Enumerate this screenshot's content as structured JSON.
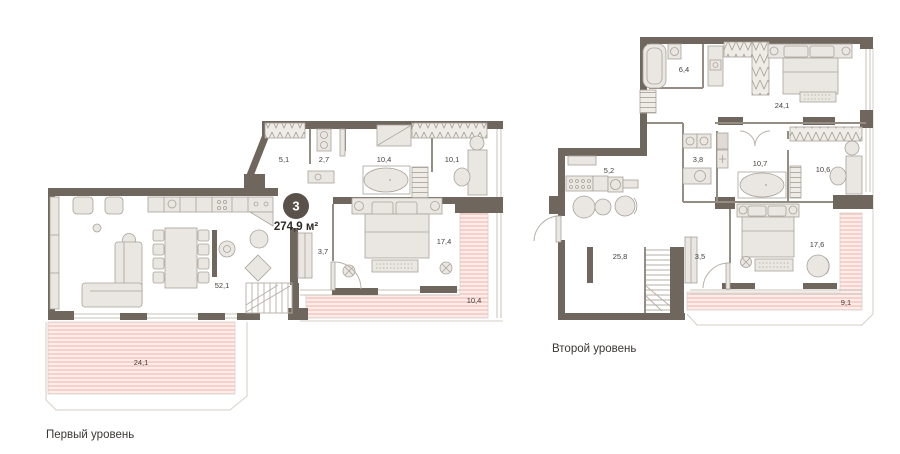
{
  "badge": {
    "number": "3",
    "total_area": "274,9 м²"
  },
  "levels": {
    "first": {
      "label": "Первый уровень",
      "rooms": {
        "r51": "5,1",
        "r27": "2,7",
        "r104": "10,4",
        "r101": "10,1",
        "r37": "3,7",
        "r521": "52,1",
        "r174": "17,4",
        "t104": "10,4",
        "t241": "24,1"
      }
    },
    "second": {
      "label": "Второй уровень",
      "rooms": {
        "r64": "6,4",
        "r241": "24,1",
        "r52": "5,2",
        "r38": "3,8",
        "r107": "10,7",
        "r106": "10,6",
        "r258": "25,8",
        "r35": "3,5",
        "r176": "17,6",
        "t91": "9,1"
      }
    }
  },
  "colors": {
    "wall": "#6F675D",
    "furniture_fill": "#EAE7E2",
    "furniture_stroke": "#A9A29A",
    "terrace_bg": "#FDEDEA",
    "terrace_line": "#F3C3BB",
    "badge_bg": "#59514A",
    "text": "#45413C"
  }
}
